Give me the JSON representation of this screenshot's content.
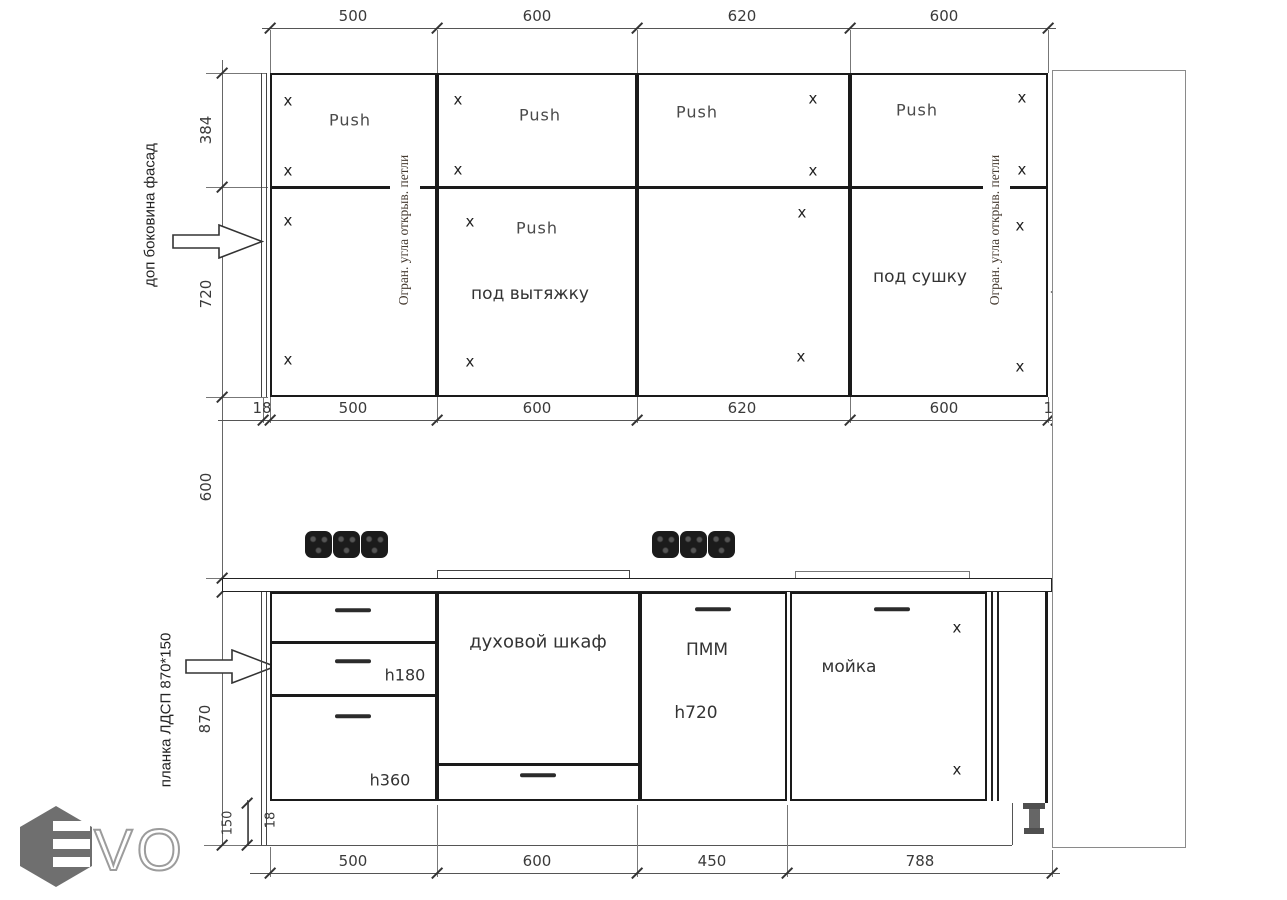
{
  "dims": {
    "top": [
      "500",
      "600",
      "620",
      "600"
    ],
    "upper_left": [
      "384",
      "720"
    ],
    "mid": [
      "18",
      "500",
      "600",
      "620",
      "600",
      "18"
    ],
    "gap_left": "600",
    "lower_left": {
      "h": "870",
      "plinth": "150",
      "panel": "18"
    },
    "bottom": [
      "500",
      "600",
      "450",
      "788"
    ]
  },
  "upper": {
    "push": "Push",
    "mark": "x",
    "hood": "под вытяжку",
    "dryer": "под сушку",
    "hinge_note": "Огран. угла открыв. петли"
  },
  "notes": {
    "left_panel": "доп боковина фасад",
    "right_panel": "доп боковина фасад",
    "plinth_strip": "планка ЛДСП 870*150"
  },
  "base": {
    "drawer_mid": "h180",
    "drawer_low": "h360",
    "oven": "духовой шкаф",
    "dishwasher": "ПММ",
    "dishwasher_h": "h720",
    "sink": "мойка",
    "mark": "x"
  },
  "logo": {
    "letters": "VO"
  }
}
